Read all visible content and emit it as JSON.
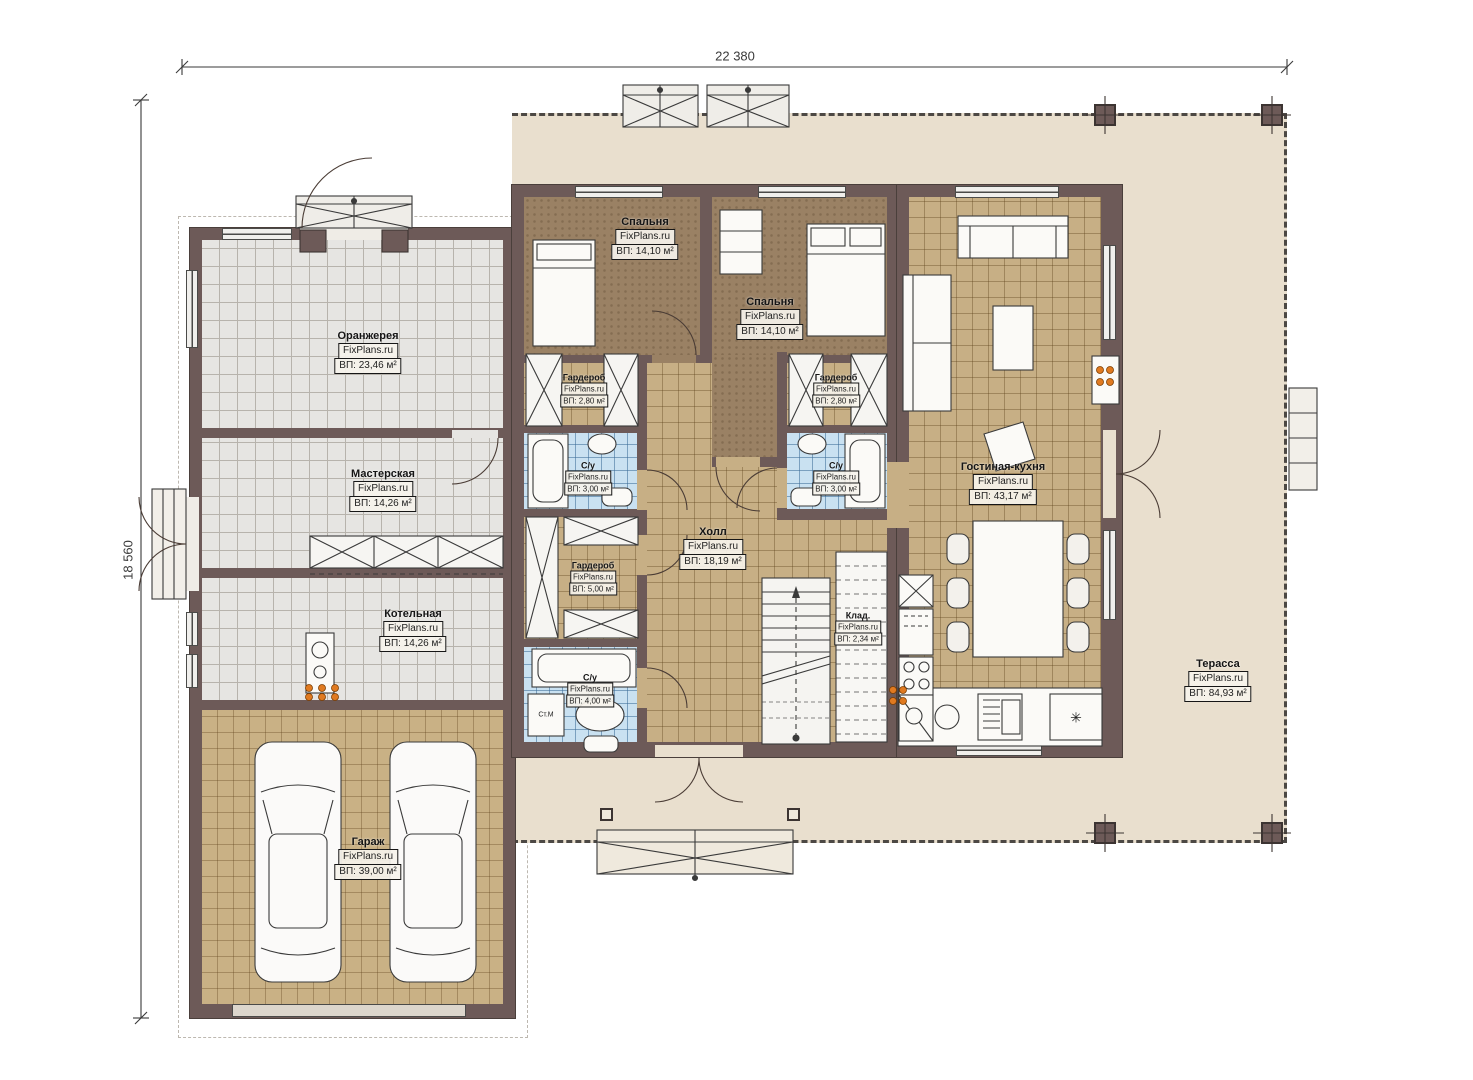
{
  "watermark": "FixPlans.ru",
  "dimensions": {
    "width_label": "22 380",
    "height_label": "18 560"
  },
  "rooms": [
    {
      "id": "orangery",
      "name": "Оранжерея",
      "area": "ВП: 23,46 м²"
    },
    {
      "id": "workshop",
      "name": "Мастерская",
      "area": "ВП: 14,26 м²"
    },
    {
      "id": "boiler",
      "name": "Котельная",
      "area": "ВП: 14,26 м²"
    },
    {
      "id": "garage",
      "name": "Гараж",
      "area": "ВП: 39,00 м²"
    },
    {
      "id": "bedroom1",
      "name": "Спальня",
      "area": "ВП: 14,10 м²"
    },
    {
      "id": "bedroom2",
      "name": "Спальня",
      "area": "ВП: 14,10 м²"
    },
    {
      "id": "wardrobe1",
      "name": "Гардероб",
      "area": "ВП: 2,80 м²"
    },
    {
      "id": "bath1",
      "name": "С/у",
      "area": "ВП: 3,00 м²"
    },
    {
      "id": "wardrobe2",
      "name": "Гардероб",
      "area": "ВП: 2,80 м²"
    },
    {
      "id": "bath2",
      "name": "С/у",
      "area": "ВП: 3,00 м²"
    },
    {
      "id": "wardrobe3",
      "name": "Гардероб",
      "area": "ВП: 5,00 м²"
    },
    {
      "id": "bath3",
      "name": "С/у",
      "area": "ВП: 4,00 м²"
    },
    {
      "id": "hall",
      "name": "Холл",
      "area": "ВП: 18,19 м²"
    },
    {
      "id": "storage",
      "name": "Клад.",
      "area": "ВП: 2,34 м²"
    },
    {
      "id": "living",
      "name": "Гостиная-кухня",
      "area": "ВП: 43,17 м²"
    },
    {
      "id": "terrace",
      "name": "Терасса",
      "area": "ВП: 84,93 м²"
    }
  ],
  "annotations": {
    "washer": "Ст.М",
    "fridge": "✳"
  },
  "colors": {
    "wall": "#6d5a58",
    "terrace": "#e9dfce",
    "bath": "#c9e1f1",
    "accent_dots": "#e07a20"
  }
}
